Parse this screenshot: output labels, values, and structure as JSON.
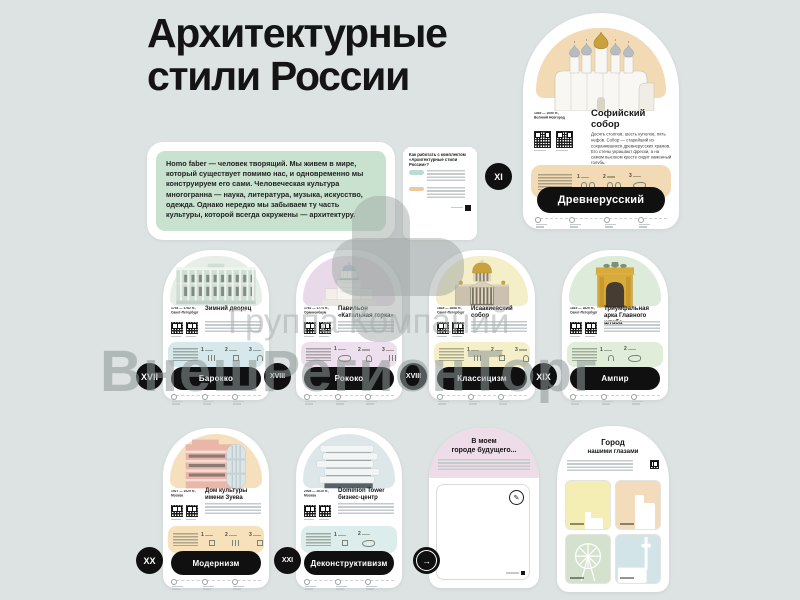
{
  "title": {
    "line1": "Архитектурные",
    "line2": "стили России"
  },
  "intro": {
    "text": "Homo faber — человек творящий. Мы живем в мире, который существует помимо нас, и одновременно мы конструируем его сами. Человеческая культура многогранна — наука, литература, музыка, искусство, одежда. Однако нередко мы забываем ту часть культуры, которой всегда окружены — архитектуру."
  },
  "howto": {
    "title": "Как работать с комплектом «Архитектурные стили России»?",
    "tag1_color": "#badcd2",
    "tag2_color": "#ecca9e"
  },
  "watermark": {
    "line1": "Группа Компаний",
    "line2": "ВнешРегионТорг"
  },
  "common": {
    "f1": "1",
    "f2": "2",
    "f3": "3"
  },
  "hero": {
    "badge": "XI",
    "style": "Древнерусский",
    "name1": "Софийский",
    "name2": "собор",
    "dates": "1045 — 1050 гг.,",
    "city": "Великий Новгород",
    "desc": "Десять столпов, шесть куполов, пять нефов. Собор — старейший из сохранившихся древнерусских храмов. Его стены украшают фрески, а на самом высоком кресте сидит каменный голубь.",
    "accent": "#f1dab4"
  },
  "cards": [
    {
      "badge": "XVII",
      "style": "Барокко",
      "name": "Зимний дворец",
      "dates": "1754 — 1762 гг.,",
      "city": "Санкт-Петербург",
      "dome": "#e7eee8",
      "band": "#d6e8ec"
    },
    {
      "badge": "XVIII",
      "style": "Рококо",
      "name": "Павильон «Катальная горка»",
      "dates": "1762 — 1774 гг.,",
      "city": "Ораниенбаум",
      "dome": "#e9dae9",
      "band": "#eedfee"
    },
    {
      "badge": "XVIII",
      "style": "Классицизм",
      "name": "Исаакиевский собор",
      "dates": "1818 — 1858 гг.,",
      "city": "Санкт-Петербург",
      "dome": "#f4eec9",
      "band": "#f5efc9"
    },
    {
      "badge": "XIX",
      "style": "Ампир",
      "name": "Триумфальная арка Главного штаба",
      "dates": "1819 — 1829 гг.,",
      "city": "Санкт-Петербург",
      "dome": "#dcebda",
      "band": "#e0edd9"
    },
    {
      "badge": "XX",
      "style": "Модернизм",
      "name": "Дом культуры имени Зуева",
      "dates": "1927 — 1929 гг.,",
      "city": "Москва",
      "dome": "#f5dfbd",
      "band": "#f7e1bb"
    },
    {
      "badge": "XXI",
      "style": "Деконструктивизм",
      "name": "Dominion Tower бизнес-центр",
      "dates": "2008 — 2015 гг.,",
      "city": "Москва",
      "dome": "#dde7ea",
      "band": "#dcedec"
    }
  ],
  "future": {
    "title1": "В моем",
    "title2": "городе будущего...",
    "arch": "#eedce9",
    "arrow": "→"
  },
  "city": {
    "title1": "Город",
    "title2": "нашими глазами",
    "tiles": [
      "#f4eeb5",
      "#f2dcbc",
      "#d3e1cd",
      "#d3e4e9"
    ]
  }
}
